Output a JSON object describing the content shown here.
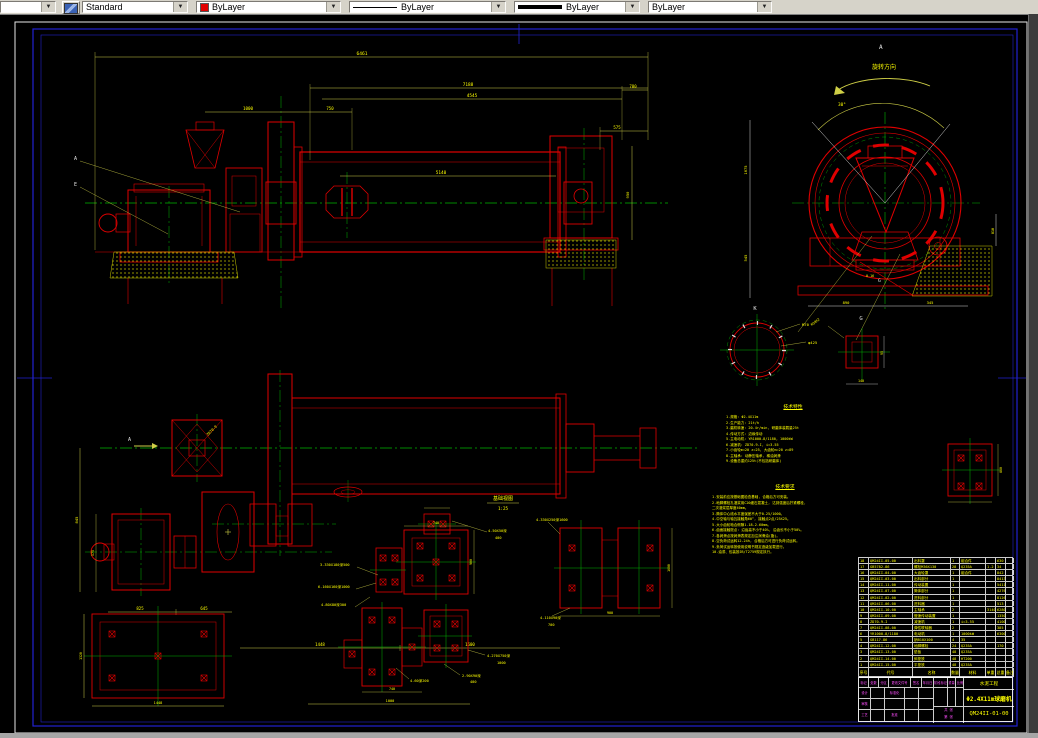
{
  "toolbar": {
    "style_value": "Standard",
    "color_value": "ByLayer",
    "linetype_value": "ByLayer",
    "lineweight_value": "ByLayer",
    "plotstyle_value": "ByLayer"
  },
  "colors": {
    "geometry_red": "#e00000",
    "centerline_green": "#00b400",
    "dim_yellow": "#ffff00",
    "frame_blue": "#2222d0",
    "titleblock_magenta": "#ff4dff"
  },
  "el": {
    "la": "A",
    "le": "E",
    "total": "6461",
    "l1": "7188",
    "l2": "4545",
    "feed": "1000",
    "d750": "750",
    "d780": "780",
    "d575": "575",
    "shell": "5140",
    "v950": "950"
  },
  "ev": {
    "la": "A",
    "rot": "旋转方向",
    "ang": "30°",
    "d890": "890",
    "d345": "345",
    "v1675": "1675",
    "v545": "545",
    "v810": "810",
    "lg": "G",
    "r": "0.16"
  },
  "kv": {
    "lk": "K",
    "m70": "M70",
    "d425": "φ425"
  },
  "gv": {
    "lg": "G",
    "m30": "M30X2",
    "d140": "140",
    "d95": "95"
  },
  "pl": {
    "la": "A",
    "zd": "ZD70-9",
    "d825": "825",
    "d645": "645",
    "d1448": "1448",
    "d1600": "1600",
    "v845": "845",
    "v575": "575"
  },
  "fd": {
    "title": "基础视图",
    "scale": "1:25",
    "c1a": "4-50X50深",
    "c1b": "400",
    "c2": "3-330X180深500",
    "c3": "6-160X160深1000",
    "c4": "4-80X80深300",
    "c5a": "4-270X750深",
    "c5b": "1000",
    "c6a": "2-90X90深",
    "c6b": "400",
    "c7": "4-60深200",
    "c8": "4-330X250深1600",
    "c9a": "4-110X90深",
    "c9b": "700",
    "d740": "740",
    "d740b": "740",
    "d900": "900",
    "d1000": "1000",
    "d1448": "1448",
    "v1320": "1320",
    "v900": "900",
    "v1600": "1600",
    "v860": "860"
  },
  "notes": {
    "tech_char": {
      "title": "技术特性",
      "lines": [
        "1.规格: Φ2.4X11m",
        "2.生产能力: 21t/h",
        "3.磨机转速: 20.4r/min, 研磨体装载量25t",
        "4.传动方式: 边缘传动",
        "5.主电动机: YR1000-8/1180, 1000kW",
        "6.减速机: ZD70-9-I, i=3.55",
        "7.小齿轮m=20 z=25, 大齿轮m=20 z=89",
        "8.主轴承: 动静压轴承, 稀油润滑",
        "9.设备总重约125t(不包括研磨体)"
      ]
    },
    "tech_req": {
      "title": "技术要求",
      "lines": [
        "1.安装前应按基础图检查基础, 合格后方可安装。",
        "2.地脚螺栓孔灌浆用C20细石混凝土, 达到强度后拧紧螺栓,",
        "  二次灌浆层厚度40mm。",
        "3.筒体中心线水平度误差不大于0.25/1000。",
        "4.中空轴与轴瓦接触角60°, 接触点2点/25X25。",
        "5.大小齿轮啮合侧隙1.18-2.60mm。",
        "6.齿面接触斑点: 沿齿高不小于40%, 沿齿长不小于50%。",
        "7.各润滑点按润滑表规定加注润滑油(脂)。",
        "8.空负荷试运转12-24h, 合格后方可进行负荷试运转。",
        "9.负荷试运转按使用说明书规定逐级加载进行。",
        "10.油漆、包装按JB/T2759规定执行。"
      ]
    }
  },
  "bom": {
    "header": [
      "序号",
      "代号",
      "名称",
      "数量",
      "材料",
      "单重",
      "总重",
      "备注"
    ],
    "rows": [
      [
        "18",
        "QM24II-05-00",
        "出料罩",
        "1",
        "组合件",
        "",
        "630",
        ""
      ],
      [
        "17",
        "GB5782-86",
        "螺栓M36X130",
        "28",
        "Q235A",
        "1.2",
        "34",
        ""
      ],
      [
        "16",
        "QM24II-04-00",
        "大齿轮罩",
        "1",
        "组合件",
        "",
        "842",
        ""
      ],
      [
        "15",
        "QM24II-03-00",
        "出料部分",
        "1",
        "",
        "",
        "8413",
        ""
      ],
      [
        "14",
        "QM24II-11-00",
        "传动装置",
        "1",
        "",
        "",
        "5411",
        ""
      ],
      [
        "13",
        "QM24II-07-00",
        "筒体部分",
        "1",
        "",
        "",
        "42765",
        ""
      ],
      [
        "12",
        "QM24II-02-00",
        "进料部分",
        "1",
        "",
        "",
        "8126",
        ""
      ],
      [
        "11",
        "QM24II-06-00",
        "进料器",
        "1",
        "",
        "",
        "513",
        ""
      ],
      [
        "10",
        "QM24II-10-00",
        "主轴承",
        "2",
        "",
        "3140",
        "6280",
        ""
      ],
      [
        "9",
        "QM24II-09-00",
        "慢速传动装置",
        "1",
        "",
        "",
        "1350",
        ""
      ],
      [
        "8",
        "ZD70-9-I",
        "减速机",
        "1",
        "i=3.55",
        "",
        "4100",
        ""
      ],
      [
        "7",
        "QM24II-08-00",
        "弹性联轴器",
        "2",
        "",
        "",
        "385",
        ""
      ],
      [
        "6",
        "YR1000-8/1180",
        "电动机",
        "1",
        "1000kW",
        "",
        "6300",
        ""
      ],
      [
        "5",
        "GB117-86",
        "销B10X100",
        "4",
        "35",
        "",
        "",
        ""
      ],
      [
        "4",
        "QM24II-12-00",
        "地脚螺栓",
        "24",
        "Q235A",
        "",
        "170",
        ""
      ],
      [
        "3",
        "QM24II-13-00",
        "垫板",
        "48",
        "Q235A",
        "",
        "",
        ""
      ],
      [
        "2",
        "QM24II-14-00",
        "斜垫铁",
        "48",
        "HT200",
        "",
        "",
        ""
      ],
      [
        "1",
        "QM24II-15-00",
        "平垫铁",
        "48",
        "Q235A",
        "",
        "",
        ""
      ]
    ]
  },
  "titleblock": {
    "row1": [
      "标记",
      "处数",
      "分区",
      "更改文件号",
      "签名",
      "年月日"
    ],
    "design": "设计",
    "check": "审核",
    "std": "标准化",
    "craft": "工艺",
    "approve": "批准",
    "stage": "阶段标记",
    "weight": "重量",
    "scale": "比例",
    "sheets": "共 张",
    "sheet": "第 张",
    "company": "水泥工程",
    "product": "Φ2.4X11m球磨机",
    "drawing_no": "QM24II-01-00"
  }
}
